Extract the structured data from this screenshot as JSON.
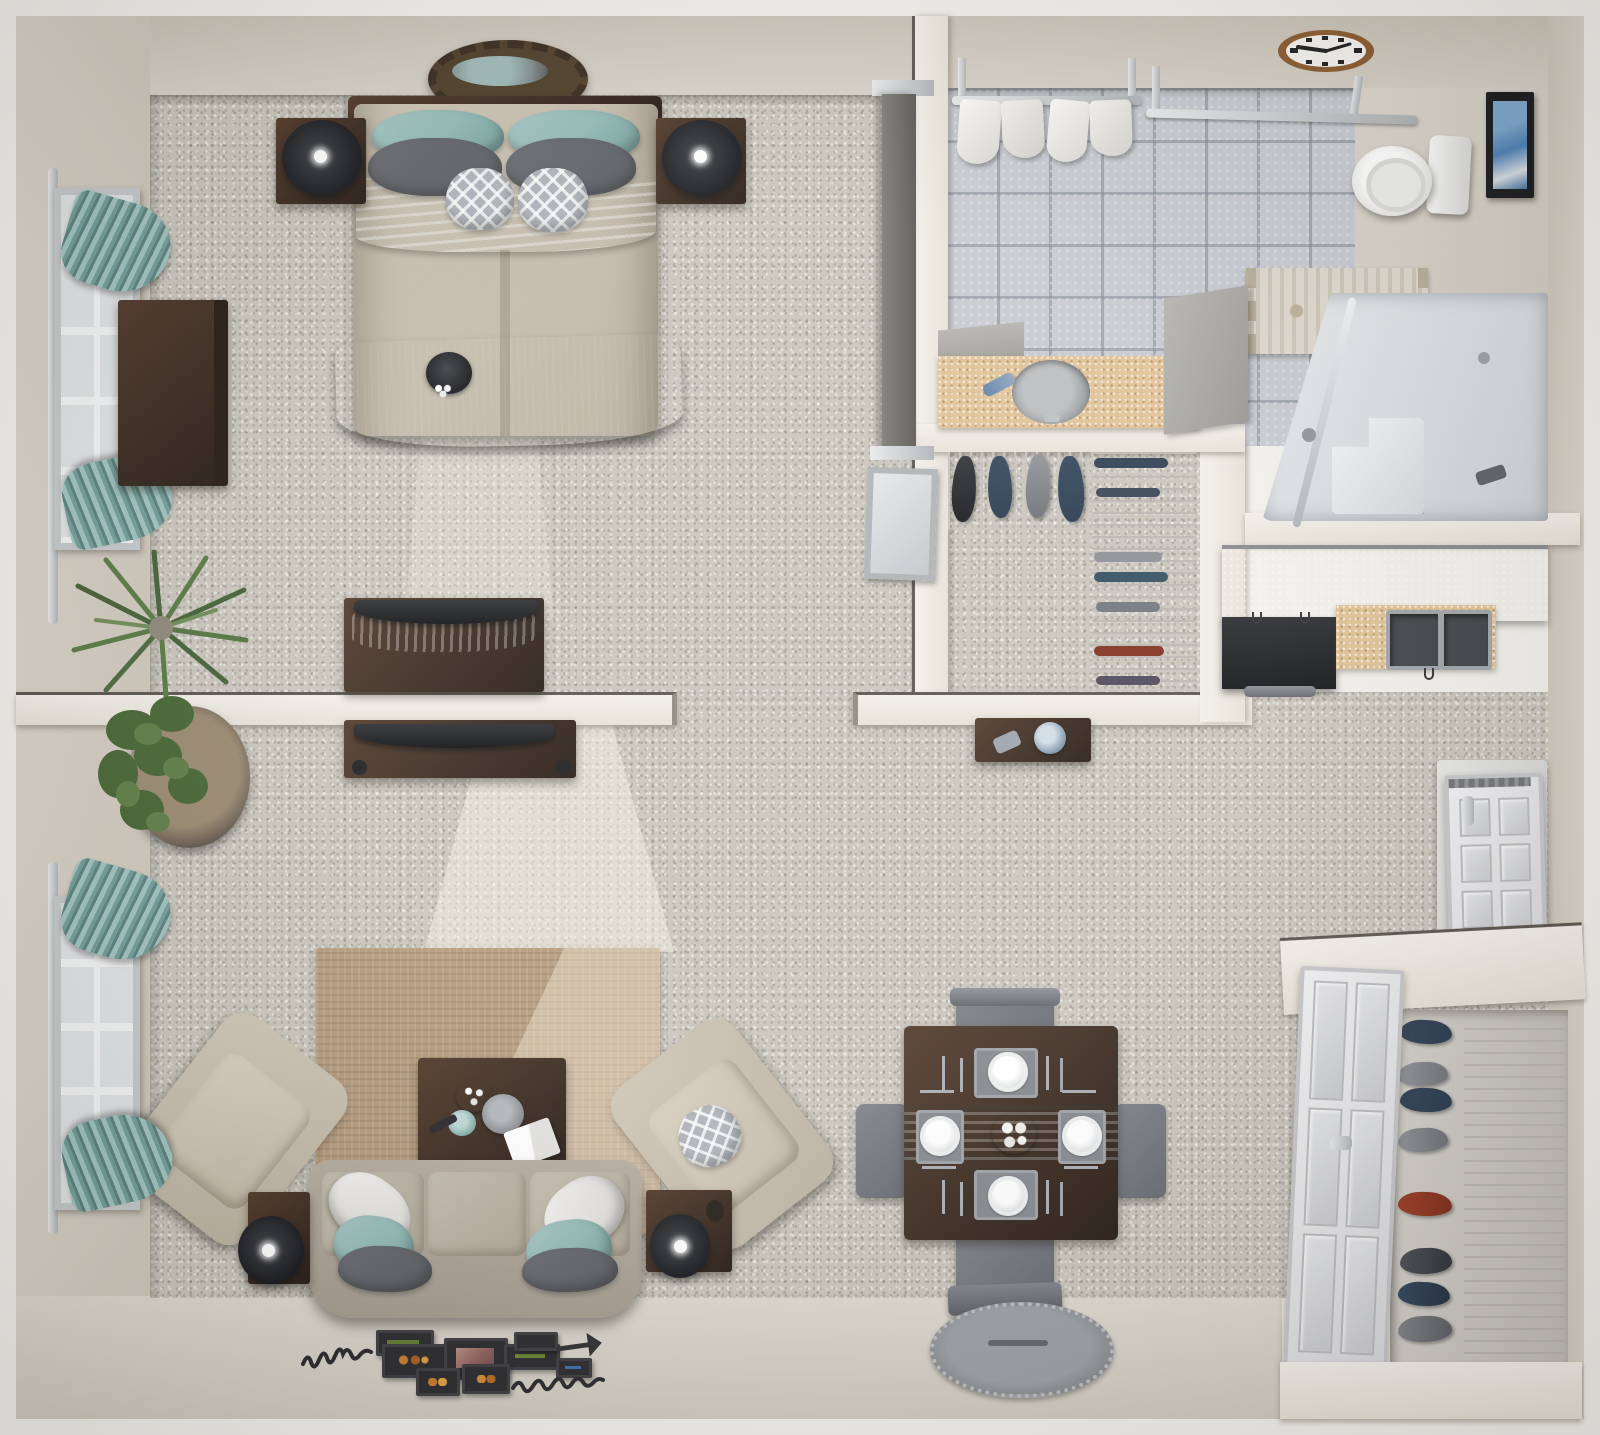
{
  "meta": {
    "title": "One-Bedroom Apartment 3D Floor Plan",
    "view": "top-down 3D render",
    "description": "Photorealistic overhead dollhouse view of a furnished one-bedroom, one-bathroom apartment"
  },
  "colors": {
    "wall": "#d7d1c6",
    "carpet": "#c8c4bb",
    "tile": "#c6c9cf",
    "counter_sand": "#dfc093",
    "wood_dark": "#35251a",
    "teal": "#8fb8b4",
    "gray_pillow": "#55585e",
    "black_fabric": "#202126",
    "shower_gray": "#dfe2e6",
    "rug_tan": "#b29879",
    "chair_gray": "#63666d",
    "lamp_black": "#131418",
    "shoe_navy": "#24364a",
    "shoe_red": "#7e2a18",
    "clock_rim": "#8a5a2e"
  },
  "rooms": {
    "bedroom": {
      "label": "Bedroom",
      "floor": "carpet",
      "furniture": [
        "bed with teal, gray and patterned pillows",
        "black throw blanket",
        "teal throw blanket",
        "two nightstands with black lamps",
        "sunburst wall mirror",
        "dresser",
        "media chest with TV and teal runner",
        "window with teal curtains",
        "spike plant"
      ]
    },
    "living_room": {
      "label": "Living Room",
      "floor": "carpet",
      "furniture": [
        "tan area rug",
        "sofa with white, teal and gray pillows",
        "two beige armchairs",
        "coffee table with trays and book",
        "two end tables with black lamps",
        "TV console",
        "fiddle-leaf plant",
        "window with teal curtains",
        "gallery wall frames and script art"
      ]
    },
    "bathroom": {
      "label": "Bathroom",
      "floor": "tile",
      "furniture": [
        "vanity with round sink",
        "toilet",
        "walk-in shower with seat",
        "patterned bath rug",
        "towel racks with four towels",
        "wall clock",
        "framed picture"
      ]
    },
    "closet": {
      "label": "Walk-in Closet",
      "floor": "carpet",
      "furniture": [
        "wire shelving with hanging shoes",
        "wire racks with folded clothes",
        "console table with cup"
      ]
    },
    "kitchen": {
      "label": "Kitchen",
      "furniture": [
        "upper cabinet run",
        "black range",
        "sand countertop with double sink"
      ]
    },
    "dining_area": {
      "label": "Dining Area",
      "furniture": [
        "dark wood table with teal runner",
        "four gray chairs",
        "four place settings",
        "center serving tray"
      ]
    },
    "entry": {
      "label": "Entry",
      "floor": "smooth",
      "furniture": [
        "white six-panel front door",
        "entry closet with wire shoe rack",
        "oval braided mat"
      ]
    }
  },
  "details": {
    "clock_time": "9:15",
    "place_settings": 4,
    "sofa_cushions": 3,
    "towels": 4,
    "bed_pillows": 6,
    "shoe_pairs_entry_closet": 8,
    "windows": 2
  }
}
